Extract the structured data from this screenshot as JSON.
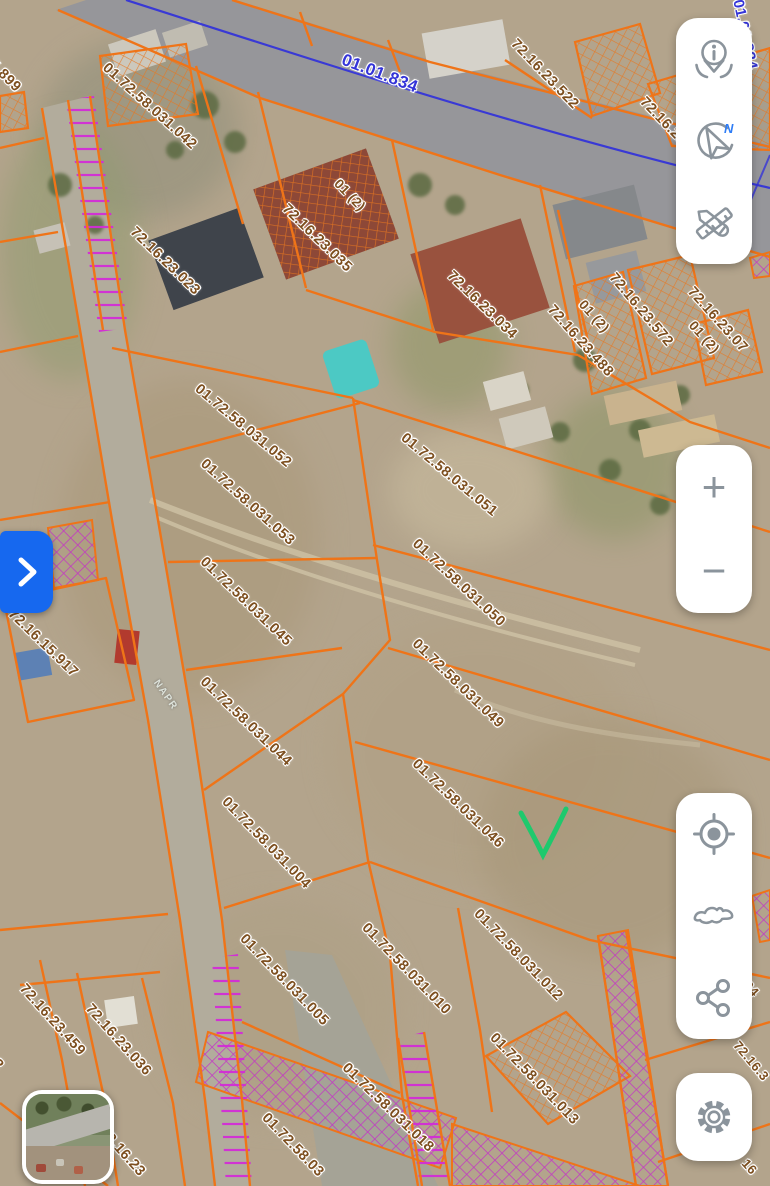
{
  "map": {
    "road_label": "01.01.834",
    "road_label_edge": "01.01.834",
    "street_label": "NAPR",
    "colors": {
      "parcel_line": "#ef7418",
      "hatch_magenta": "#c42cc9",
      "road_blue": "#3434d8",
      "label_brown": "#7d4f1f",
      "check_green": "#1ec96d",
      "accent_blue": "#1668ef",
      "icon_gray": "#8b949c"
    },
    "parcel_labels": [
      {
        "text": "72.16.15.899",
        "x": -40,
        "y": 20,
        "rot": 45
      },
      {
        "text": "01.72.58.031.042",
        "x": 110,
        "y": 60,
        "rot": 42
      },
      {
        "text": "72.16.23.522",
        "x": 519,
        "y": 36,
        "rot": 46
      },
      {
        "text": "72.16.23.5",
        "x": 648,
        "y": 94,
        "rot": 46
      },
      {
        "text": "01 (2)",
        "x": 342,
        "y": 176,
        "rot": 46,
        "size": 13.5
      },
      {
        "text": "72.16.23.035",
        "x": 290,
        "y": 201,
        "rot": 44
      },
      {
        "text": "72.16.23.023",
        "x": 138,
        "y": 224,
        "rot": 44
      },
      {
        "text": "72.16.23.034",
        "x": 455,
        "y": 268,
        "rot": 44
      },
      {
        "text": "72.16.23.488",
        "x": 556,
        "y": 302,
        "rot": 48
      },
      {
        "text": "01 (2)",
        "x": 587,
        "y": 297,
        "rot": 48,
        "size": 13.5
      },
      {
        "text": "72.16.23.572",
        "x": 618,
        "y": 270,
        "rot": 50
      },
      {
        "text": "01 (2)",
        "x": 697,
        "y": 318,
        "rot": 48,
        "size": 13.5
      },
      {
        "text": "72.16.23.07",
        "x": 696,
        "y": 284,
        "rot": 48
      },
      {
        "text": "01.72.58.031.052",
        "x": 202,
        "y": 381,
        "rot": 40
      },
      {
        "text": "01.72.58.031.051",
        "x": 408,
        "y": 430,
        "rot": 40
      },
      {
        "text": "01.72.58.031.053",
        "x": 208,
        "y": 456,
        "rot": 42
      },
      {
        "text": "01.72.58.031.050",
        "x": 420,
        "y": 536,
        "rot": 43
      },
      {
        "text": "01.72.58.031.045",
        "x": 208,
        "y": 554,
        "rot": 44
      },
      {
        "text": "01.72.58.031.049",
        "x": 420,
        "y": 636,
        "rot": 44
      },
      {
        "text": "01.72.58.031.044",
        "x": 208,
        "y": 674,
        "rot": 44
      },
      {
        "text": "01.72.58.031.046",
        "x": 420,
        "y": 756,
        "rot": 44
      },
      {
        "text": "01.72.58.031.004",
        "x": 230,
        "y": 794,
        "rot": 46
      },
      {
        "text": "01.72.58.031.005",
        "x": 248,
        "y": 931,
        "rot": 46
      },
      {
        "text": "01.72.58.031.010",
        "x": 370,
        "y": 920,
        "rot": 46
      },
      {
        "text": "01.72.58.031.012",
        "x": 482,
        "y": 906,
        "rot": 46
      },
      {
        "text": "01.72.58.031.013",
        "x": 498,
        "y": 1030,
        "rot": 46
      },
      {
        "text": "01.72.58.031.018",
        "x": 350,
        "y": 1060,
        "rot": 44
      },
      {
        "text": "01.72.58.03",
        "x": 270,
        "y": 1110,
        "rot": 46
      },
      {
        "text": "72.16.23.459",
        "x": 28,
        "y": 981,
        "rot": 48
      },
      {
        "text": "72.16.23.036",
        "x": 94,
        "y": 1001,
        "rot": 48
      },
      {
        "text": "72.16.2",
        "x": -28,
        "y": 1024,
        "rot": 48
      },
      {
        "text": "72.16.23",
        "x": 108,
        "y": 1124,
        "rot": 48
      },
      {
        "text": "72.16.15.917",
        "x": 16,
        "y": 606,
        "rot": 44
      },
      {
        "text": "04",
        "x": 752,
        "y": 978,
        "rot": 48,
        "size": 13
      },
      {
        "text": "72.16.3",
        "x": 742,
        "y": 1038,
        "rot": 50,
        "size": 13
      },
      {
        "text": "16",
        "x": 750,
        "y": 1156,
        "rot": 48,
        "size": 13
      }
    ]
  },
  "controls": {
    "info_button": {
      "icon": "info-pin-icon"
    },
    "compass_button": {
      "icon": "compass-north-icon",
      "north_label": "N"
    },
    "measure_button": {
      "icon": "measure-tools-icon"
    },
    "zoom_in": {
      "label": "+"
    },
    "zoom_out": {
      "label": "−"
    },
    "locate_button": {
      "icon": "target-icon"
    },
    "region_button": {
      "icon": "georgia-outline-icon"
    },
    "share_button": {
      "icon": "share-icon"
    },
    "settings_button": {
      "icon": "gear-icon"
    },
    "expand_button": {
      "icon": "chevron-right-icon"
    },
    "minimap": {
      "name": "basemap-thumbnail"
    }
  }
}
